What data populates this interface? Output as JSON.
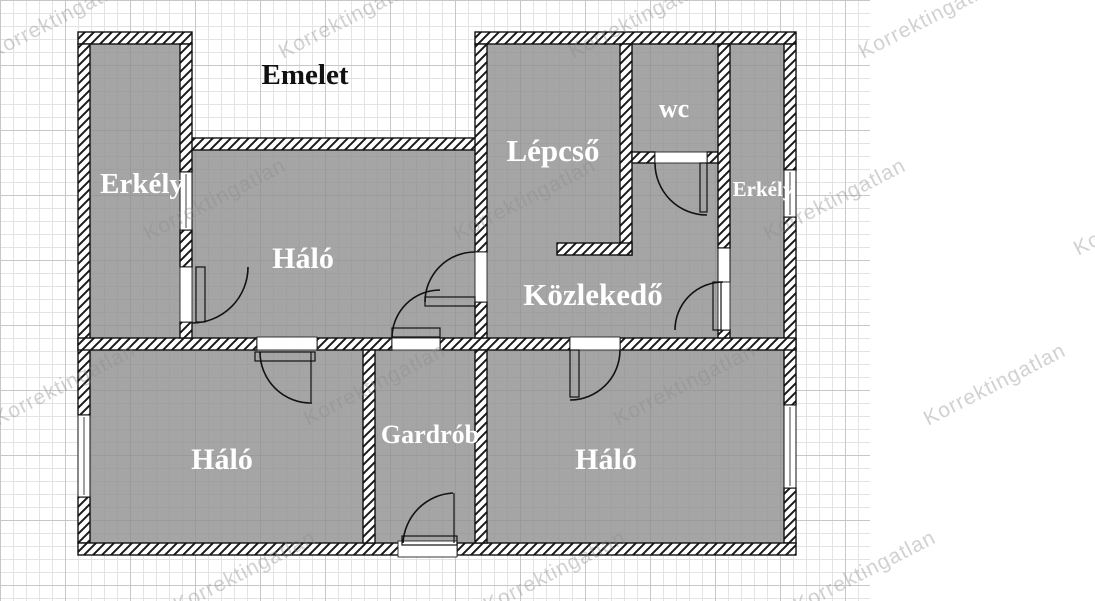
{
  "title": "Emelet",
  "rooms": {
    "erkely_left": {
      "label": "Erkély"
    },
    "halo_top": {
      "label": "Háló"
    },
    "lepcso": {
      "label": "Lépcső"
    },
    "wc": {
      "label": "wc"
    },
    "erkely_right": {
      "label": "Erkély"
    },
    "kozlekedo": {
      "label": "Közlekedő"
    },
    "halo_bottom_left": {
      "label": "Háló"
    },
    "gardrob": {
      "label": "Gardrób"
    },
    "halo_bottom_right": {
      "label": "Háló"
    }
  },
  "watermark": {
    "text": "Korrektingatlan",
    "color": "rgba(140,140,140,0.40)",
    "positions": [
      [
        60,
        18
      ],
      [
        350,
        18
      ],
      [
        640,
        18
      ],
      [
        930,
        18
      ],
      [
        215,
        200
      ],
      [
        525,
        200
      ],
      [
        835,
        200
      ],
      [
        1145,
        215
      ],
      [
        65,
        385
      ],
      [
        375,
        385
      ],
      [
        685,
        385
      ],
      [
        995,
        385
      ],
      [
        245,
        572
      ],
      [
        555,
        572
      ],
      [
        865,
        572
      ],
      [
        1175,
        572
      ]
    ]
  },
  "colors": {
    "room_fill": "#8f8f8f",
    "wall_hatch_line": "#1a1a1a",
    "label_text": "#ffffff",
    "title_text": "#111111",
    "grid_minor": "#e3e3e3",
    "grid_major": "#c7c7c7"
  }
}
